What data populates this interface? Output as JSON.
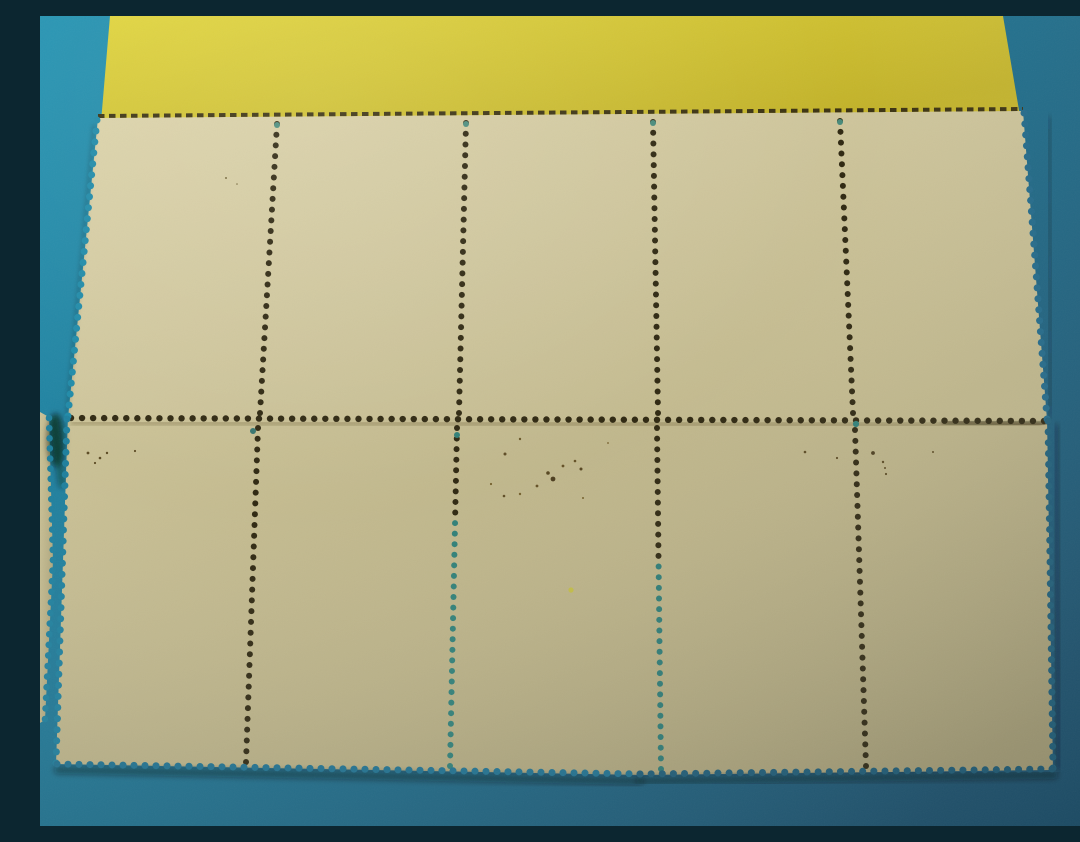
{
  "scene": {
    "description": "Photograph of mint postage stamp strips placed gum-side up (blank backs) on a teal surface with a yellow card along the top edge; two full strips of five stamps each plus a narrow stamp sliver at the left edge, all with perforated edges and perforation hole rows",
    "canvas": {
      "width": 1080,
      "height": 810
    },
    "colors": {
      "teal_background": "#1d7593",
      "yellow_card": "#d5c733",
      "stamp_paper_upper": "#cec59b",
      "stamp_paper_lower": "#bab186",
      "perforation_hole": "#2e2710",
      "gum_teal_hole": "#2f7f77"
    },
    "gradients": [
      {
        "id": "gBg",
        "type": "linear",
        "x1": 0,
        "y1": 0,
        "x2": 1,
        "y2": 0.75,
        "stops": [
          [
            "0",
            "#2192b1"
          ],
          [
            "0.45",
            "#1d7593"
          ],
          [
            "1",
            "#1a516e"
          ]
        ]
      },
      {
        "id": "gYellow",
        "type": "linear",
        "x1": 0,
        "y1": 0,
        "x2": 1,
        "y2": 0.6,
        "stops": [
          [
            "0",
            "#e0d43a"
          ],
          [
            "1",
            "#c2b229"
          ]
        ]
      },
      {
        "id": "gUpper",
        "type": "linear",
        "x1": 0,
        "y1": 0,
        "x2": 1,
        "y2": 0.8,
        "stops": [
          [
            "0",
            "#dcd3a9"
          ],
          [
            "0.5",
            "#cec59b"
          ],
          [
            "1",
            "#bfb68a"
          ]
        ]
      },
      {
        "id": "gLower",
        "type": "linear",
        "x1": 0,
        "y1": 0,
        "x2": 1,
        "y2": 0.85,
        "stops": [
          [
            "0",
            "#ccc397"
          ],
          [
            "0.55",
            "#bab186"
          ],
          [
            "1",
            "#a79e75"
          ]
        ]
      },
      {
        "id": "gLight",
        "type": "radial",
        "cx": 0.25,
        "cy": 0.1,
        "r": 1.25,
        "stops": [
          [
            "0",
            "rgba(255,255,250,0.10)"
          ],
          [
            "0.4",
            "rgba(255,255,255,0)"
          ],
          [
            "1",
            "rgba(0,12,20,0.22)"
          ]
        ]
      }
    ],
    "blur_filters": [
      2,
      3
    ],
    "polygons": [
      {
        "name": "teal-backdrop",
        "points": "0,0 1080,0 1080,810 0,810",
        "fill": "url(#gBg)"
      },
      {
        "name": "yellow-card",
        "points": "70,0 963,0 981,106 61,106",
        "fill": "url(#gYellow)"
      },
      {
        "name": "stamp-sliver-left",
        "points": "0,396 9,401 13,545 5,704 0,707",
        "fill": "url(#gLower)"
      },
      {
        "name": "lower-stamp-strip",
        "points": "28,400 1007,402 1013,754 600,759 16,748",
        "fill": "url(#gLower)"
      },
      {
        "name": "upper-stamp-strip",
        "points": "58,102 983,95 1007,404 28,402",
        "fill": "url(#gUpper)"
      }
    ],
    "shadow_blobs": [
      {
        "name": "gap-shadow-blob",
        "cx": 16,
        "cy": 424,
        "rx": 9,
        "ry": 27,
        "color": "rgba(8,14,10,0.5)",
        "blur": 3
      }
    ],
    "shadow_lines": [
      {
        "name": "junction-shadow",
        "x1": 32,
        "y1": 407,
        "x2": 1000,
        "y2": 409,
        "color": "rgba(60,48,18,0.28)",
        "width": 4,
        "blur": 2
      },
      {
        "name": "junction-shadow-right",
        "x1": 905,
        "y1": 406,
        "x2": 1004,
        "y2": 408,
        "color": "rgba(30,22,8,0.5)",
        "width": 6,
        "blur": 2
      },
      {
        "name": "bottom-shadow-left",
        "x1": 18,
        "y1": 754,
        "x2": 600,
        "y2": 765,
        "color": "rgba(6,16,22,0.45)",
        "width": 8,
        "blur": 3
      },
      {
        "name": "bottom-shadow-right",
        "x1": 600,
        "y1": 765,
        "x2": 1014,
        "y2": 759,
        "color": "rgba(6,16,22,0.45)",
        "width": 8,
        "blur": 3
      },
      {
        "name": "right-shadow-lower",
        "x1": 1016,
        "y1": 410,
        "x2": 1019,
        "y2": 752,
        "color": "rgba(6,16,22,0.38)",
        "width": 5,
        "blur": 3
      },
      {
        "name": "right-shadow-upper",
        "x1": 1009,
        "y1": 102,
        "x2": 1011,
        "y2": 400,
        "color": "rgba(6,16,22,0.3)",
        "width": 4,
        "blur": 3
      },
      {
        "name": "left-shadow-upper",
        "x1": 54,
        "y1": 110,
        "x2": 27,
        "y2": 398,
        "color": "rgba(10,18,12,0.22)",
        "width": 3,
        "blur": 2
      },
      {
        "name": "sliver-gap-shadow",
        "x1": 14,
        "y1": 404,
        "x2": 22,
        "y2": 468,
        "color": "rgba(8,16,14,0.35)",
        "width": 8,
        "blur": 3
      }
    ],
    "dash_lines": [
      {
        "name": "top-perforation-edge",
        "x1": 58,
        "y1": 100,
        "x2": 983,
        "y2": 93,
        "width": 4,
        "dash": "6.5 4.5",
        "color": "#3a3110"
      }
    ],
    "dot_lines": [
      {
        "name": "junction-perforation-row",
        "x1": 31,
        "y1": 402,
        "x2": 1004,
        "y2": 405,
        "r": 3.2,
        "spacing": 11,
        "color": "#2e2710"
      },
      {
        "name": "upper-perf-col-1",
        "x1": 237,
        "y1": 108,
        "x2": 220,
        "y2": 397,
        "r": 3,
        "spacing": 10.7,
        "color": "#2e2710"
      },
      {
        "name": "upper-perf-col-2",
        "x1": 426,
        "y1": 107,
        "x2": 419,
        "y2": 397,
        "r": 3,
        "spacing": 10.7,
        "color": "#2e2710"
      },
      {
        "name": "upper-perf-col-3",
        "x1": 613,
        "y1": 106,
        "x2": 618,
        "y2": 397,
        "r": 3,
        "spacing": 10.7,
        "color": "#2e2710"
      },
      {
        "name": "upper-perf-col-4",
        "x1": 800,
        "y1": 105,
        "x2": 813,
        "y2": 397,
        "r": 3,
        "spacing": 10.7,
        "color": "#2e2710"
      },
      {
        "name": "lower-perf-col-1",
        "x1": 218,
        "y1": 412,
        "x2": 206,
        "y2": 746,
        "r": 3,
        "spacing": 10.7,
        "color": "#2e2710"
      },
      {
        "name": "lower-perf-col-2",
        "x1": 417,
        "y1": 412,
        "x2": 410,
        "y2": 750,
        "r": 3,
        "spacing": 10.7,
        "color": "#2e2710",
        "color2": "#2f7f77",
        "split": 0.28
      },
      {
        "name": "lower-perf-col-3",
        "x1": 617,
        "y1": 412,
        "x2": 621,
        "y2": 753,
        "r": 3,
        "spacing": 10.7,
        "color": "#2e2710",
        "color2": "#2c7a74",
        "split": 0.38
      },
      {
        "name": "lower-perf-col-4",
        "x1": 815,
        "y1": 414,
        "x2": 826,
        "y2": 750,
        "r": 3,
        "spacing": 10.7,
        "color": "#2e2710"
      },
      {
        "name": "upper-left-scallops",
        "x1": 57,
        "y1": 104,
        "x2": 28,
        "y2": 400,
        "r": 3.5,
        "spacing": 11,
        "color": "#1e8aa8"
      },
      {
        "name": "upper-right-scallops",
        "x1": 984,
        "y1": 97,
        "x2": 1007,
        "y2": 403,
        "r": 3.5,
        "spacing": 11,
        "color": "#206888"
      },
      {
        "name": "lower-left-scallops",
        "x1": 27,
        "y1": 403,
        "x2": 16,
        "y2": 747,
        "r": 3.5,
        "spacing": 11,
        "color": "#1d7f9d"
      },
      {
        "name": "lower-right-scallops",
        "x1": 1008,
        "y1": 405,
        "x2": 1013,
        "y2": 752,
        "r": 3.5,
        "spacing": 11,
        "color": "#1d5e79"
      },
      {
        "name": "bottom-scallops-left",
        "x1": 17,
        "y1": 748,
        "x2": 600,
        "y2": 758,
        "r": 3.5,
        "spacing": 11,
        "color": "#1e7190"
      },
      {
        "name": "bottom-scallops-right",
        "x1": 600,
        "y1": 758,
        "x2": 1012,
        "y2": 753,
        "r": 3.5,
        "spacing": 11,
        "color": "#1c5b76"
      },
      {
        "name": "sliver-scallops-upper",
        "x1": 9,
        "y1": 402,
        "x2": 13,
        "y2": 544,
        "r": 3.3,
        "spacing": 10.5,
        "color": "#1d7f9d"
      },
      {
        "name": "sliver-scallops-lower",
        "x1": 13,
        "y1": 544,
        "x2": 5,
        "y2": 703,
        "r": 3.3,
        "spacing": 10.5,
        "color": "#1d7f9d"
      }
    ],
    "single_holes": [
      {
        "name": "teal-hole-1",
        "x": 237,
        "y": 109,
        "r": 3,
        "color": "#4a8c7c"
      },
      {
        "name": "teal-hole-2",
        "x": 426,
        "y": 108,
        "r": 3,
        "color": "#4a8c7c"
      },
      {
        "name": "teal-hole-3",
        "x": 613,
        "y": 107,
        "r": 3,
        "color": "#478a7a"
      },
      {
        "name": "teal-hole-4",
        "x": 800,
        "y": 106,
        "r": 3,
        "color": "#478a7a"
      },
      {
        "name": "teal-hole-5",
        "x": 816,
        "y": 408,
        "r": 3.1,
        "color": "#2f7f77"
      },
      {
        "name": "teal-hole-6",
        "x": 417,
        "y": 419,
        "r": 3,
        "color": "#2f7f77"
      },
      {
        "name": "teal-hole-7",
        "x": 213,
        "y": 415,
        "r": 3,
        "color": "#36746e"
      }
    ],
    "specks": [
      {
        "x": 480,
        "y": 423,
        "r": 1.2,
        "color": "#5f4c1e"
      },
      {
        "x": 465,
        "y": 438,
        "r": 1.5,
        "color": "#53401a"
      },
      {
        "x": 508,
        "y": 457,
        "r": 1.8,
        "color": "#4a3a14"
      },
      {
        "x": 513,
        "y": 463,
        "r": 2.4,
        "color": "#3f3012"
      },
      {
        "x": 523,
        "y": 450,
        "r": 1.4,
        "color": "#5a451a"
      },
      {
        "x": 535,
        "y": 445,
        "r": 1.3,
        "color": "#5a451a"
      },
      {
        "x": 541,
        "y": 453,
        "r": 1.5,
        "color": "#4a3814"
      },
      {
        "x": 497,
        "y": 470,
        "r": 1.4,
        "color": "#5a451a"
      },
      {
        "x": 480,
        "y": 478,
        "r": 1.2,
        "color": "#6a5520"
      },
      {
        "x": 464,
        "y": 480,
        "r": 1.3,
        "color": "#53401a"
      },
      {
        "x": 451,
        "y": 468,
        "r": 1.1,
        "color": "#6a5520"
      },
      {
        "x": 568,
        "y": 427,
        "r": 0.9,
        "color": "#6a5520"
      },
      {
        "x": 543,
        "y": 482,
        "r": 1.0,
        "color": "#6a5520"
      },
      {
        "x": 48,
        "y": 437,
        "r": 1.4,
        "color": "#4f3d16"
      },
      {
        "x": 60,
        "y": 442,
        "r": 1.3,
        "color": "#4f3d16"
      },
      {
        "x": 67,
        "y": 437,
        "r": 1.2,
        "color": "#4f3d16"
      },
      {
        "x": 55,
        "y": 447,
        "r": 1.1,
        "color": "#4f3d16"
      },
      {
        "x": 95,
        "y": 435,
        "r": 1.1,
        "color": "#4f3d16"
      },
      {
        "x": 765,
        "y": 436,
        "r": 1.3,
        "color": "#4f3d16"
      },
      {
        "x": 797,
        "y": 442,
        "r": 1.1,
        "color": "#4f3d16"
      },
      {
        "x": 833,
        "y": 437,
        "r": 1.9,
        "color": "#3f3012"
      },
      {
        "x": 843,
        "y": 446,
        "r": 1.2,
        "color": "#4f3d16"
      },
      {
        "x": 845,
        "y": 452,
        "r": 1.0,
        "color": "#4f3d16"
      },
      {
        "x": 846,
        "y": 458,
        "r": 1.1,
        "color": "#4f3d16"
      },
      {
        "x": 893,
        "y": 436,
        "r": 1.0,
        "color": "#4f3d16"
      },
      {
        "x": 186,
        "y": 162,
        "r": 1.0,
        "color": "#6b5d30"
      },
      {
        "x": 197,
        "y": 168,
        "r": 0.8,
        "color": "#6b5d30"
      },
      {
        "x": 531,
        "y": 574,
        "r": 2.6,
        "color": "#c2bd3e"
      }
    ]
  }
}
